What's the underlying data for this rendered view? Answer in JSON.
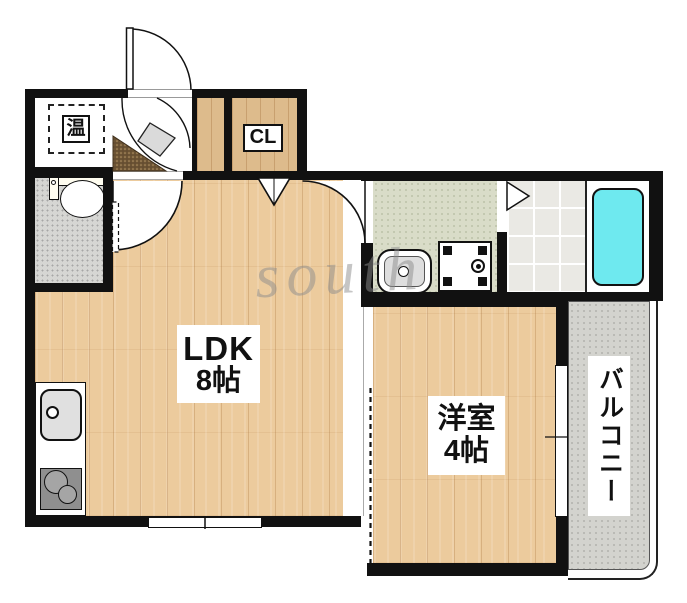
{
  "watermark": "south",
  "rooms": {
    "ldk": {
      "label": "LDK",
      "size": "8帖"
    },
    "western_room": {
      "label": "洋室",
      "size": "4帖"
    },
    "balcony": {
      "label": "バルコニー"
    },
    "closet": {
      "label": "CL"
    },
    "water_heater": {
      "label": "温"
    }
  },
  "fixtures": {
    "kitchen": [
      "kitchen-sink",
      "two-burner-stove"
    ],
    "sanitary": [
      "toilet",
      "washbasin",
      "washing-machine-pan",
      "bathtub"
    ],
    "doors": [
      "entrance-door",
      "living-door",
      "washroom-door",
      "toilet-door",
      "closet-folding-door",
      "bathroom-folding-door",
      "sliding-partition"
    ],
    "windows": [
      "ldk-south-window",
      "western-room-balcony-window"
    ]
  },
  "colors": {
    "wall": "#111111",
    "wood_floor": "#eccb9d",
    "closet_wood": "#ddbb8c",
    "washroom_floor": "#d9dcc8",
    "bath_tile": "#eae9e4",
    "toilet_floor": "#d6d6d3",
    "balcony_floor": "#d3d3ce",
    "bathtub": "#6ee9ef",
    "entrance_mat": "#6c5434"
  }
}
